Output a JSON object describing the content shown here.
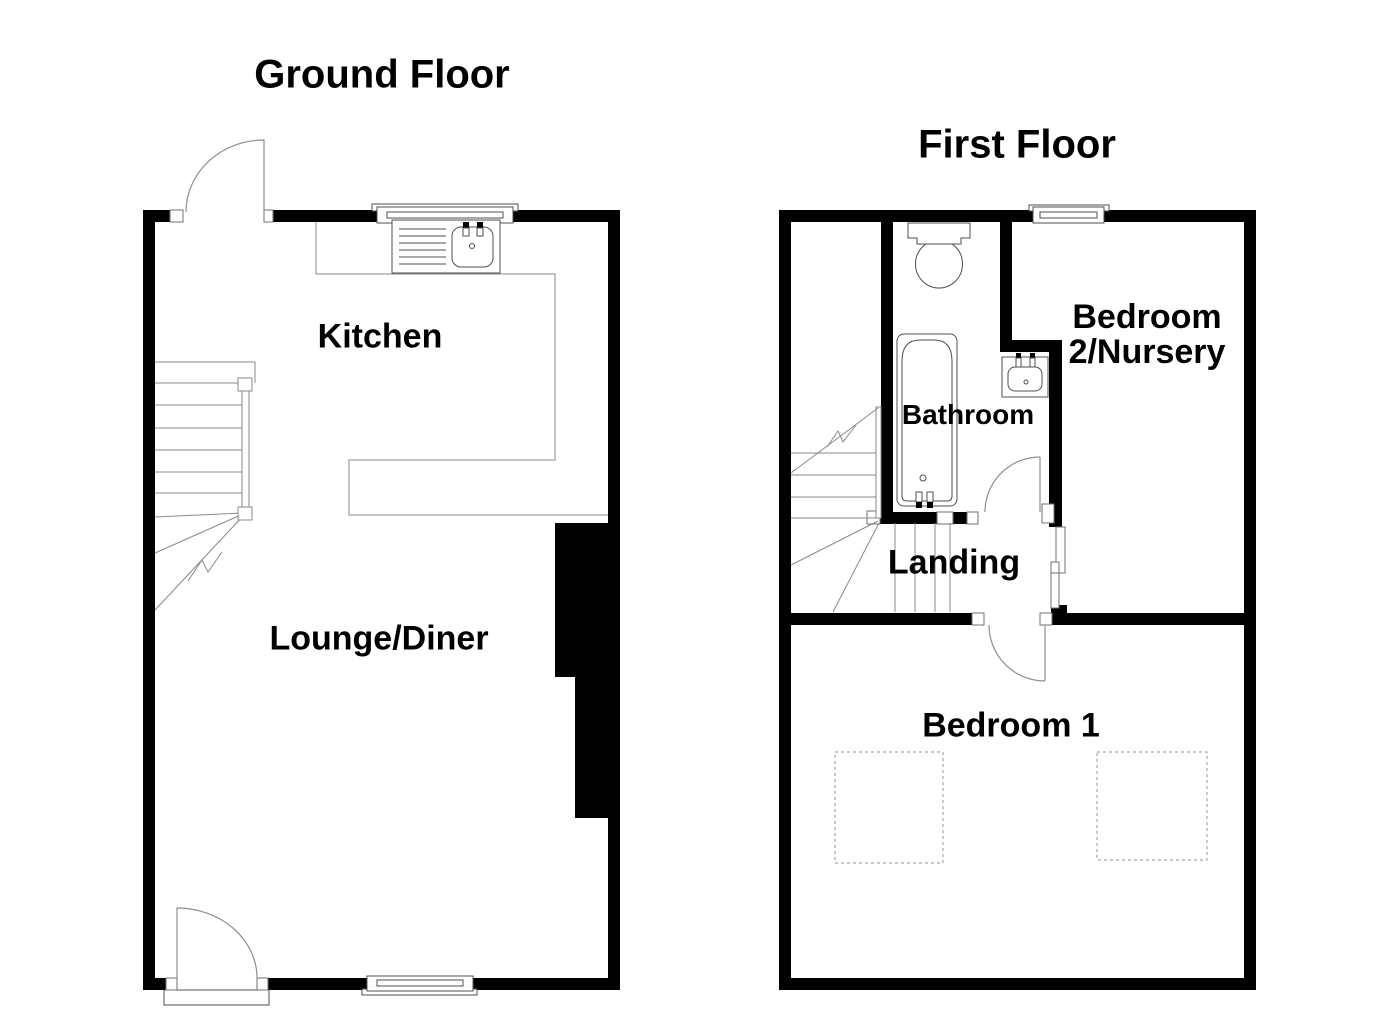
{
  "colors": {
    "bg": "#ffffff",
    "wall": "#000000",
    "line": "#4f4f4f",
    "stair": "#8a8a8a",
    "dash": "#a8a8a8",
    "text": "#000000"
  },
  "ground_floor": {
    "title": "Ground Floor",
    "rooms": {
      "kitchen": "Kitchen",
      "lounge_diner": "Lounge/Diner"
    },
    "fixtures": [
      "back-door-icon",
      "front-door-icon",
      "kitchen-window-icon",
      "lounge-window-icon",
      "kitchen-sink-icon",
      "ground-staircase-icon",
      "chimney-breast"
    ]
  },
  "first_floor": {
    "title": "First Floor",
    "rooms": {
      "bathroom": "Bathroom",
      "landing": "Landing",
      "bedroom2_line1": "Bedroom",
      "bedroom2_line2": "2/Nursery",
      "bedroom1": "Bedroom 1"
    },
    "fixtures": [
      "toilet-icon",
      "bathtub-icon",
      "wash-basin-icon",
      "bedroom2-window-icon",
      "bathroom-door-icon",
      "bedroom1-door-icon",
      "first-staircase-icon",
      "bedroom1-dashed-area-left",
      "bedroom1-dashed-area-right"
    ]
  }
}
